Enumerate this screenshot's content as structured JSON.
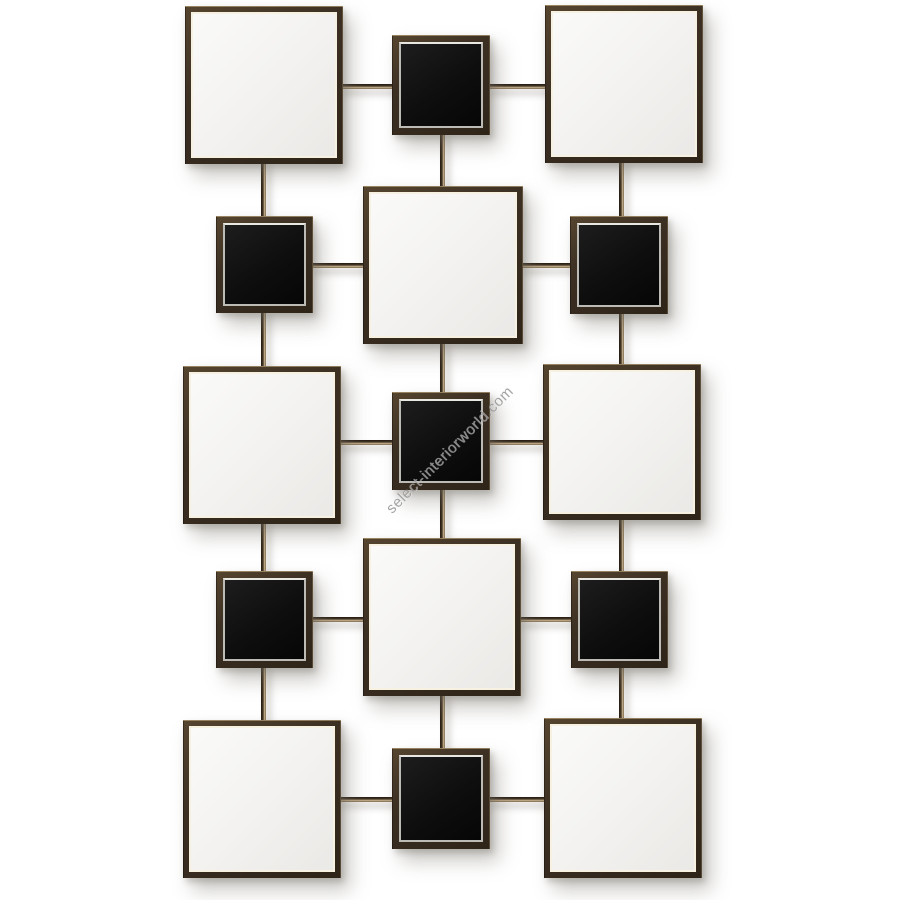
{
  "watermark": {
    "text": "select-interiorworld.com",
    "color": "#989898",
    "angle_deg": -45
  },
  "palette": {
    "background": "#ffffff",
    "frame_brown_dark": "#2e2418",
    "frame_brown": "#3c3023",
    "frame_brown_light": "#56452f",
    "frame_edge_highlight": "#d2b98c",
    "mirror_glass_light": "#fafaf9",
    "mirror_glass_dark": "#eae9e6",
    "mirror_inner_line": "#f7f1e1",
    "black_glass": "#0e0e0e",
    "black_inner_line": "#bdbbb5",
    "rod_dark": "#201911",
    "rod_highlight": "#cdb894",
    "shadow": "rgba(115,110,100,0.38)"
  },
  "composition": {
    "canvas": {
      "w": 900,
      "h": 900
    },
    "mirrors": [
      {
        "x": 185,
        "y": 6,
        "w": 158,
        "h": 158
      },
      {
        "x": 545,
        "y": 5,
        "w": 158,
        "h": 158
      },
      {
        "x": 363,
        "y": 186,
        "w": 160,
        "h": 158
      },
      {
        "x": 183,
        "y": 366,
        "w": 158,
        "h": 158
      },
      {
        "x": 543,
        "y": 364,
        "w": 158,
        "h": 156
      },
      {
        "x": 363,
        "y": 538,
        "w": 158,
        "h": 158
      },
      {
        "x": 183,
        "y": 720,
        "w": 158,
        "h": 158
      },
      {
        "x": 544,
        "y": 718,
        "w": 158,
        "h": 160
      }
    ],
    "black_squares": [
      {
        "x": 392,
        "y": 35,
        "w": 98,
        "h": 100
      },
      {
        "x": 216,
        "y": 216,
        "w": 97,
        "h": 97
      },
      {
        "x": 570,
        "y": 216,
        "w": 98,
        "h": 98
      },
      {
        "x": 392,
        "y": 392,
        "w": 98,
        "h": 98
      },
      {
        "x": 216,
        "y": 571,
        "w": 97,
        "h": 97
      },
      {
        "x": 571,
        "y": 571,
        "w": 97,
        "h": 97
      },
      {
        "x": 392,
        "y": 748,
        "w": 98,
        "h": 101
      }
    ],
    "rods_vertical": [
      {
        "x": 261,
        "y": 161,
        "len": 58
      },
      {
        "x": 261,
        "y": 310,
        "len": 59
      },
      {
        "x": 261,
        "y": 521,
        "len": 53
      },
      {
        "x": 261,
        "y": 665,
        "len": 58
      },
      {
        "x": 440,
        "y": 132,
        "len": 57
      },
      {
        "x": 440,
        "y": 341,
        "len": 54
      },
      {
        "x": 440,
        "y": 487,
        "len": 54
      },
      {
        "x": 440,
        "y": 693,
        "len": 58
      },
      {
        "x": 619,
        "y": 160,
        "len": 59
      },
      {
        "x": 619,
        "y": 311,
        "len": 56
      },
      {
        "x": 619,
        "y": 517,
        "len": 57
      },
      {
        "x": 619,
        "y": 665,
        "len": 56
      }
    ],
    "rods_horizontal": [
      {
        "x": 340,
        "y": 84,
        "len": 55
      },
      {
        "x": 487,
        "y": 84,
        "len": 61
      },
      {
        "x": 310,
        "y": 263,
        "len": 56
      },
      {
        "x": 520,
        "y": 263,
        "len": 53
      },
      {
        "x": 338,
        "y": 440,
        "len": 57
      },
      {
        "x": 487,
        "y": 440,
        "len": 59
      },
      {
        "x": 310,
        "y": 617,
        "len": 56
      },
      {
        "x": 520,
        "y": 617,
        "len": 54
      },
      {
        "x": 338,
        "y": 797,
        "len": 57
      },
      {
        "x": 487,
        "y": 797,
        "len": 60
      }
    ]
  }
}
